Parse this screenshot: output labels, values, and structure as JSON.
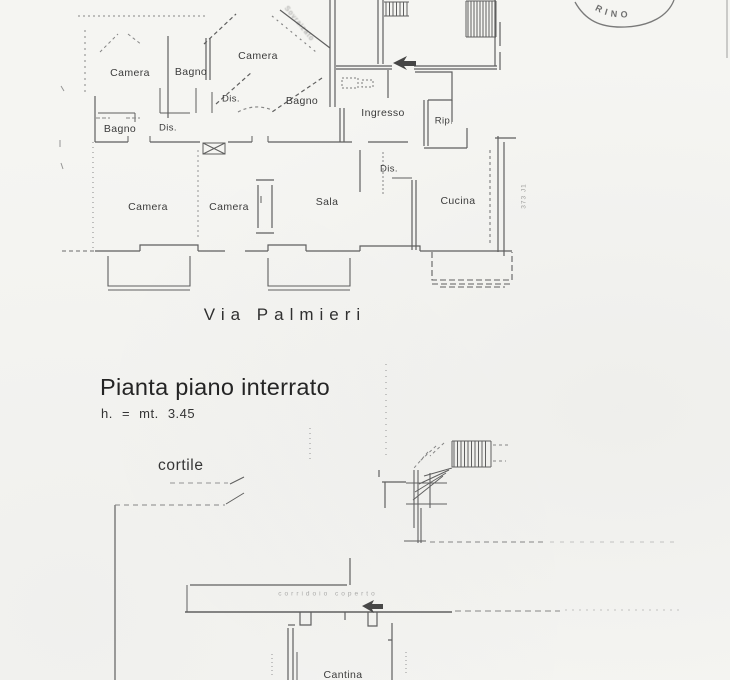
{
  "colors": {
    "paper": "#f5f5f2",
    "ink": "#474747"
  },
  "stamp": {
    "visible_text": "RINO"
  },
  "upper_plan": {
    "labels": [
      {
        "text": "Camera"
      },
      {
        "text": "Bagno"
      },
      {
        "text": "Camera"
      },
      {
        "text": "Bagno"
      },
      {
        "text": "Dis."
      },
      {
        "text": "Ingresso"
      },
      {
        "text": "Bagno"
      },
      {
        "text": "Dis."
      },
      {
        "text": "Rip."
      },
      {
        "text": "Dis."
      },
      {
        "text": "Camera"
      },
      {
        "text": "Camera"
      },
      {
        "text": "Sala"
      },
      {
        "text": "Cucina"
      }
    ],
    "diagonal_note": "Sovralzato",
    "side_note": "373 J1",
    "street_label": "Via Palmieri"
  },
  "lower_plan": {
    "title": "Pianta piano interrato",
    "height_note": "h. = mt. 3.45",
    "courtyard_label": "cortile",
    "corridor_note": "corridoio coperto",
    "cellar_label": "Cantina"
  }
}
